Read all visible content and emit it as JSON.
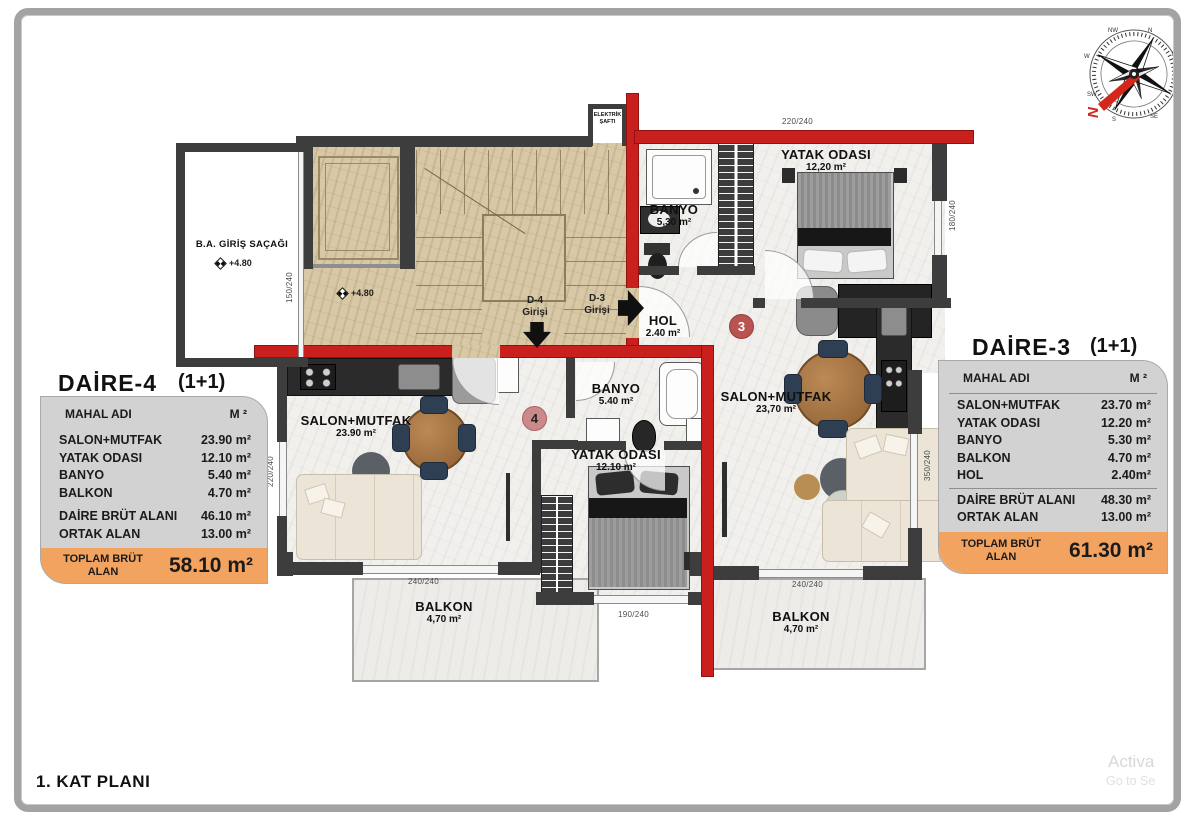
{
  "page": {
    "title": "1. KAT PLANI",
    "watermark_line1": "Activa",
    "watermark_line2": "Go to Se"
  },
  "compass": {
    "directions": [
      "N",
      "NE",
      "E",
      "SE",
      "S",
      "SW",
      "W",
      "NW"
    ],
    "needle_mark": "N"
  },
  "tables": {
    "daire4": {
      "title": "DAİRE-4",
      "plan_type": "(1+1)",
      "header": {
        "name": "MAHAL ADI",
        "unit": "M ²"
      },
      "rooms": [
        {
          "label": "SALON+MUTFAK",
          "value": "23.90 m²"
        },
        {
          "label": "YATAK ODASI",
          "value": "12.10 m²"
        },
        {
          "label": "BANYO",
          "value": "5.40 m²"
        },
        {
          "label": "BALKON",
          "value": "4.70 m²"
        }
      ],
      "summary": [
        {
          "label": "DAİRE BRÜT ALANI",
          "value": "46.10 m²"
        },
        {
          "label": "ORTAK ALAN",
          "value": "13.00 m²"
        }
      ],
      "total": {
        "label": "TOPLAM BRÜT ALAN",
        "value": "58.10 m²"
      }
    },
    "daire3": {
      "title": "DAİRE-3",
      "plan_type": "(1+1)",
      "header": {
        "name": "MAHAL ADI",
        "unit": "M ²"
      },
      "rooms": [
        {
          "label": "SALON+MUTFAK",
          "value": "23.70 m²"
        },
        {
          "label": "YATAK ODASI",
          "value": "12.20 m²"
        },
        {
          "label": "BANYO",
          "value": "5.30 m²"
        },
        {
          "label": "BALKON",
          "value": "4.70 m²"
        },
        {
          "label": "HOL",
          "value": "2.40m²"
        }
      ],
      "summary": [
        {
          "label": "DAİRE BRÜT ALANI",
          "value": "48.30 m²"
        },
        {
          "label": "ORTAK ALAN",
          "value": "13.00 m²"
        }
      ],
      "total": {
        "label": "TOPLAM BRÜT ALAN",
        "value": "61.30 m²"
      }
    }
  },
  "plan": {
    "rooms": {
      "banyo3": {
        "name": "BANYO",
        "area": "5,30 m²"
      },
      "yatak3": {
        "name": "YATAK ODASI",
        "area": "12,20 m²"
      },
      "hol": {
        "name": "HOL",
        "area": "2.40 m²"
      },
      "salon3": {
        "name": "SALON+MUTFAK",
        "area": "23,70 m²"
      },
      "balkon3": {
        "name": "BALKON",
        "area": "4,70 m²"
      },
      "salon4": {
        "name": "SALON+MUTFAK",
        "area": "23.90 m²"
      },
      "banyo4": {
        "name": "BANYO",
        "area": "5.40 m²"
      },
      "yatak4": {
        "name": "YATAK ODASI",
        "area": "12.10 m²"
      },
      "balkon4": {
        "name": "BALKON",
        "area": "4,70 m²"
      },
      "canopy": {
        "name": "B.A. GİRİŞ SAÇAĞI"
      },
      "shaft": {
        "line1": "ELEKTRİK",
        "line2": "ŞAFTI"
      }
    },
    "entries": {
      "d4": {
        "line1": "D-4",
        "line2": "Girişi"
      },
      "d3": {
        "line1": "D-3",
        "line2": "Girişi"
      }
    },
    "badges": {
      "d4": "4",
      "d3": "3"
    },
    "elevations": {
      "canopy": "+4.80",
      "hall": "+4.80"
    },
    "dimensions": {
      "top": "220/240",
      "yatak3_side": "180/240",
      "salon3_side": "350/240",
      "salon3_window": "240/240",
      "salon4_window": "240/240",
      "yatak4_window": "190/240",
      "salon4_side": "220/240",
      "canopy_side": "150/240"
    }
  },
  "colors": {
    "highlight_wall": "#c9201d",
    "wall": "#3d3d3d",
    "table_fill": "#d2d2d2",
    "total_fill": "#f2a360",
    "stair_floor": "#d8c8a6",
    "apartment_floor": "#f1f0ed"
  }
}
